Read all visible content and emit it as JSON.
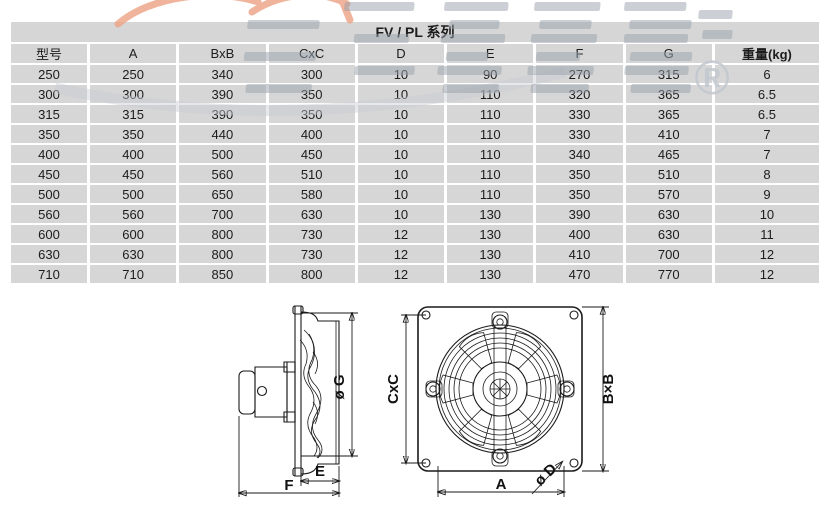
{
  "title": "FV / PL 系列",
  "watermark": {
    "registered_mark": "®"
  },
  "table": {
    "columns": [
      "型号",
      "A",
      "BxB",
      "CxC",
      "D",
      "E",
      "F",
      "G",
      "重量(kg)"
    ],
    "rows": [
      [
        "250",
        "250",
        "340",
        "300",
        "10",
        "90",
        "270",
        "315",
        "6"
      ],
      [
        "300",
        "300",
        "390",
        "350",
        "10",
        "110",
        "320",
        "365",
        "6.5"
      ],
      [
        "315",
        "315",
        "390",
        "350",
        "10",
        "110",
        "330",
        "365",
        "6.5"
      ],
      [
        "350",
        "350",
        "440",
        "400",
        "10",
        "110",
        "330",
        "410",
        "7"
      ],
      [
        "400",
        "400",
        "500",
        "450",
        "10",
        "110",
        "340",
        "465",
        "7"
      ],
      [
        "450",
        "450",
        "560",
        "510",
        "10",
        "110",
        "350",
        "510",
        "8"
      ],
      [
        "500",
        "500",
        "650",
        "580",
        "10",
        "110",
        "350",
        "570",
        "9"
      ],
      [
        "560",
        "560",
        "700",
        "630",
        "10",
        "130",
        "390",
        "630",
        "10"
      ],
      [
        "600",
        "600",
        "800",
        "730",
        "12",
        "130",
        "400",
        "630",
        "11"
      ],
      [
        "630",
        "630",
        "800",
        "730",
        "12",
        "130",
        "410",
        "700",
        "12"
      ],
      [
        "710",
        "710",
        "850",
        "800",
        "12",
        "130",
        "470",
        "770",
        "12"
      ]
    ]
  },
  "drawings": {
    "side_view": {
      "labels": {
        "diameter_g": "ø G",
        "dim_e": "E",
        "dim_f": "F"
      }
    },
    "front_view": {
      "labels": {
        "dim_cxc": "CxC",
        "dim_bxb": "B×B",
        "dim_a": "A",
        "diameter_d": "ø D"
      }
    }
  },
  "colors": {
    "cell_bg": "#d6d6d6",
    "line": "#1a1a1a",
    "watermark_gray": "#9aa3ae",
    "watermark_orange": "#eda183"
  }
}
